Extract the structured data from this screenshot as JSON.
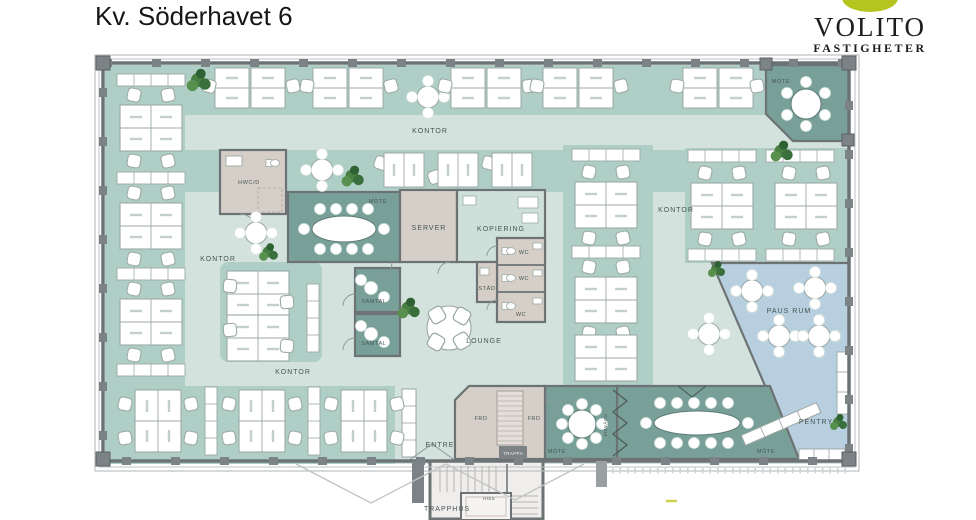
{
  "title": "Kv. Söderhavet 6",
  "logo": {
    "brand": "VOLITO",
    "tagline": "FASTIGHETER",
    "mark_color": "#b5c41f"
  },
  "colors": {
    "floor_light": "#d3e2dd",
    "floor_office": "#aecec6",
    "meeting_room": "#78a098",
    "pause_room": "#b7cfdf",
    "utility_room": "#d6cfc8",
    "wall": "#6d7375"
  },
  "floorplan": {
    "labels": [
      {
        "id": "kontor-top",
        "text": "KONTOR"
      },
      {
        "id": "kontor-left",
        "text": "KONTOR"
      },
      {
        "id": "kontor-bottom",
        "text": "KONTOR"
      },
      {
        "id": "kontor-right",
        "text": "KONTOR"
      },
      {
        "id": "mote-center",
        "text": "MÖTE"
      },
      {
        "id": "mote-topright",
        "text": "MÖTE"
      },
      {
        "id": "mote-mid",
        "text": "MÖTE"
      },
      {
        "id": "mote-big",
        "text": "MÖTE"
      },
      {
        "id": "server",
        "text": "SERVER"
      },
      {
        "id": "kopiering",
        "text": "KOPIERING"
      },
      {
        "id": "hwcd",
        "text": "HWC/D"
      },
      {
        "id": "wc-1",
        "text": "WC"
      },
      {
        "id": "wc-2",
        "text": "WC"
      },
      {
        "id": "wc-3",
        "text": "WC"
      },
      {
        "id": "stad",
        "text": "STÄD"
      },
      {
        "id": "samtal-1",
        "text": "SAMTAL"
      },
      {
        "id": "samtal-2",
        "text": "SAMTAL"
      },
      {
        "id": "lounge",
        "text": "LOUNGE"
      },
      {
        "id": "pausrum",
        "text": "PAUS RUM"
      },
      {
        "id": "pentry",
        "text": "PENTRY"
      },
      {
        "id": "frd-1",
        "text": "FRD"
      },
      {
        "id": "frd-2",
        "text": "FRD"
      },
      {
        "id": "entre",
        "text": "ENTRE"
      },
      {
        "id": "trappa",
        "text": "TRAPPA"
      },
      {
        "id": "trapphus",
        "text": "TRAPPHUS"
      },
      {
        "id": "hiss",
        "text": "HISS"
      },
      {
        "id": "vikvagg",
        "text": "VIKVÄGG"
      }
    ]
  }
}
